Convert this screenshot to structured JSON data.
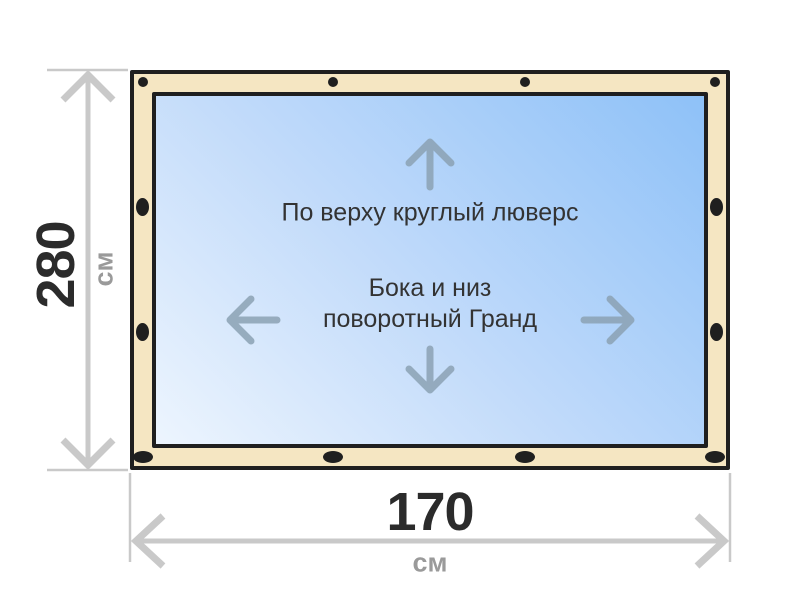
{
  "diagram": {
    "product_notes": {
      "top_note": "По верху круглый люверс",
      "middle_note_line1": "Бока и низ",
      "middle_note_line2": "поворотный Гранд"
    },
    "dimensions": {
      "height": {
        "value": "280",
        "unit": "см"
      },
      "width": {
        "value": "170",
        "unit": "см"
      }
    },
    "icons": {
      "direction_arrows": [
        "up-arrow-icon",
        "down-arrow-icon",
        "left-arrow-icon",
        "right-arrow-icon"
      ],
      "grommets": {
        "top_row": "round-grommet-icon",
        "bottom_row": "oval-grommet-icon",
        "sides": "oval-grommet-icon"
      }
    },
    "colors": {
      "frame_fill": "#f5e6c2",
      "frame_border": "#1f1f1f",
      "grommet": "#1f1f1f",
      "canvas_gradient_start": "#edf5fe",
      "canvas_gradient_mid": "#c2dbfa",
      "canvas_gradient_end": "#8ec1f8",
      "direction_arrow": "#8ba1b3",
      "dimension_line": "#c9c9c9",
      "dimension_value_text": "#2b2b2b",
      "dimension_unit_text": "#9a9a9a",
      "note_text": "#333333"
    }
  }
}
